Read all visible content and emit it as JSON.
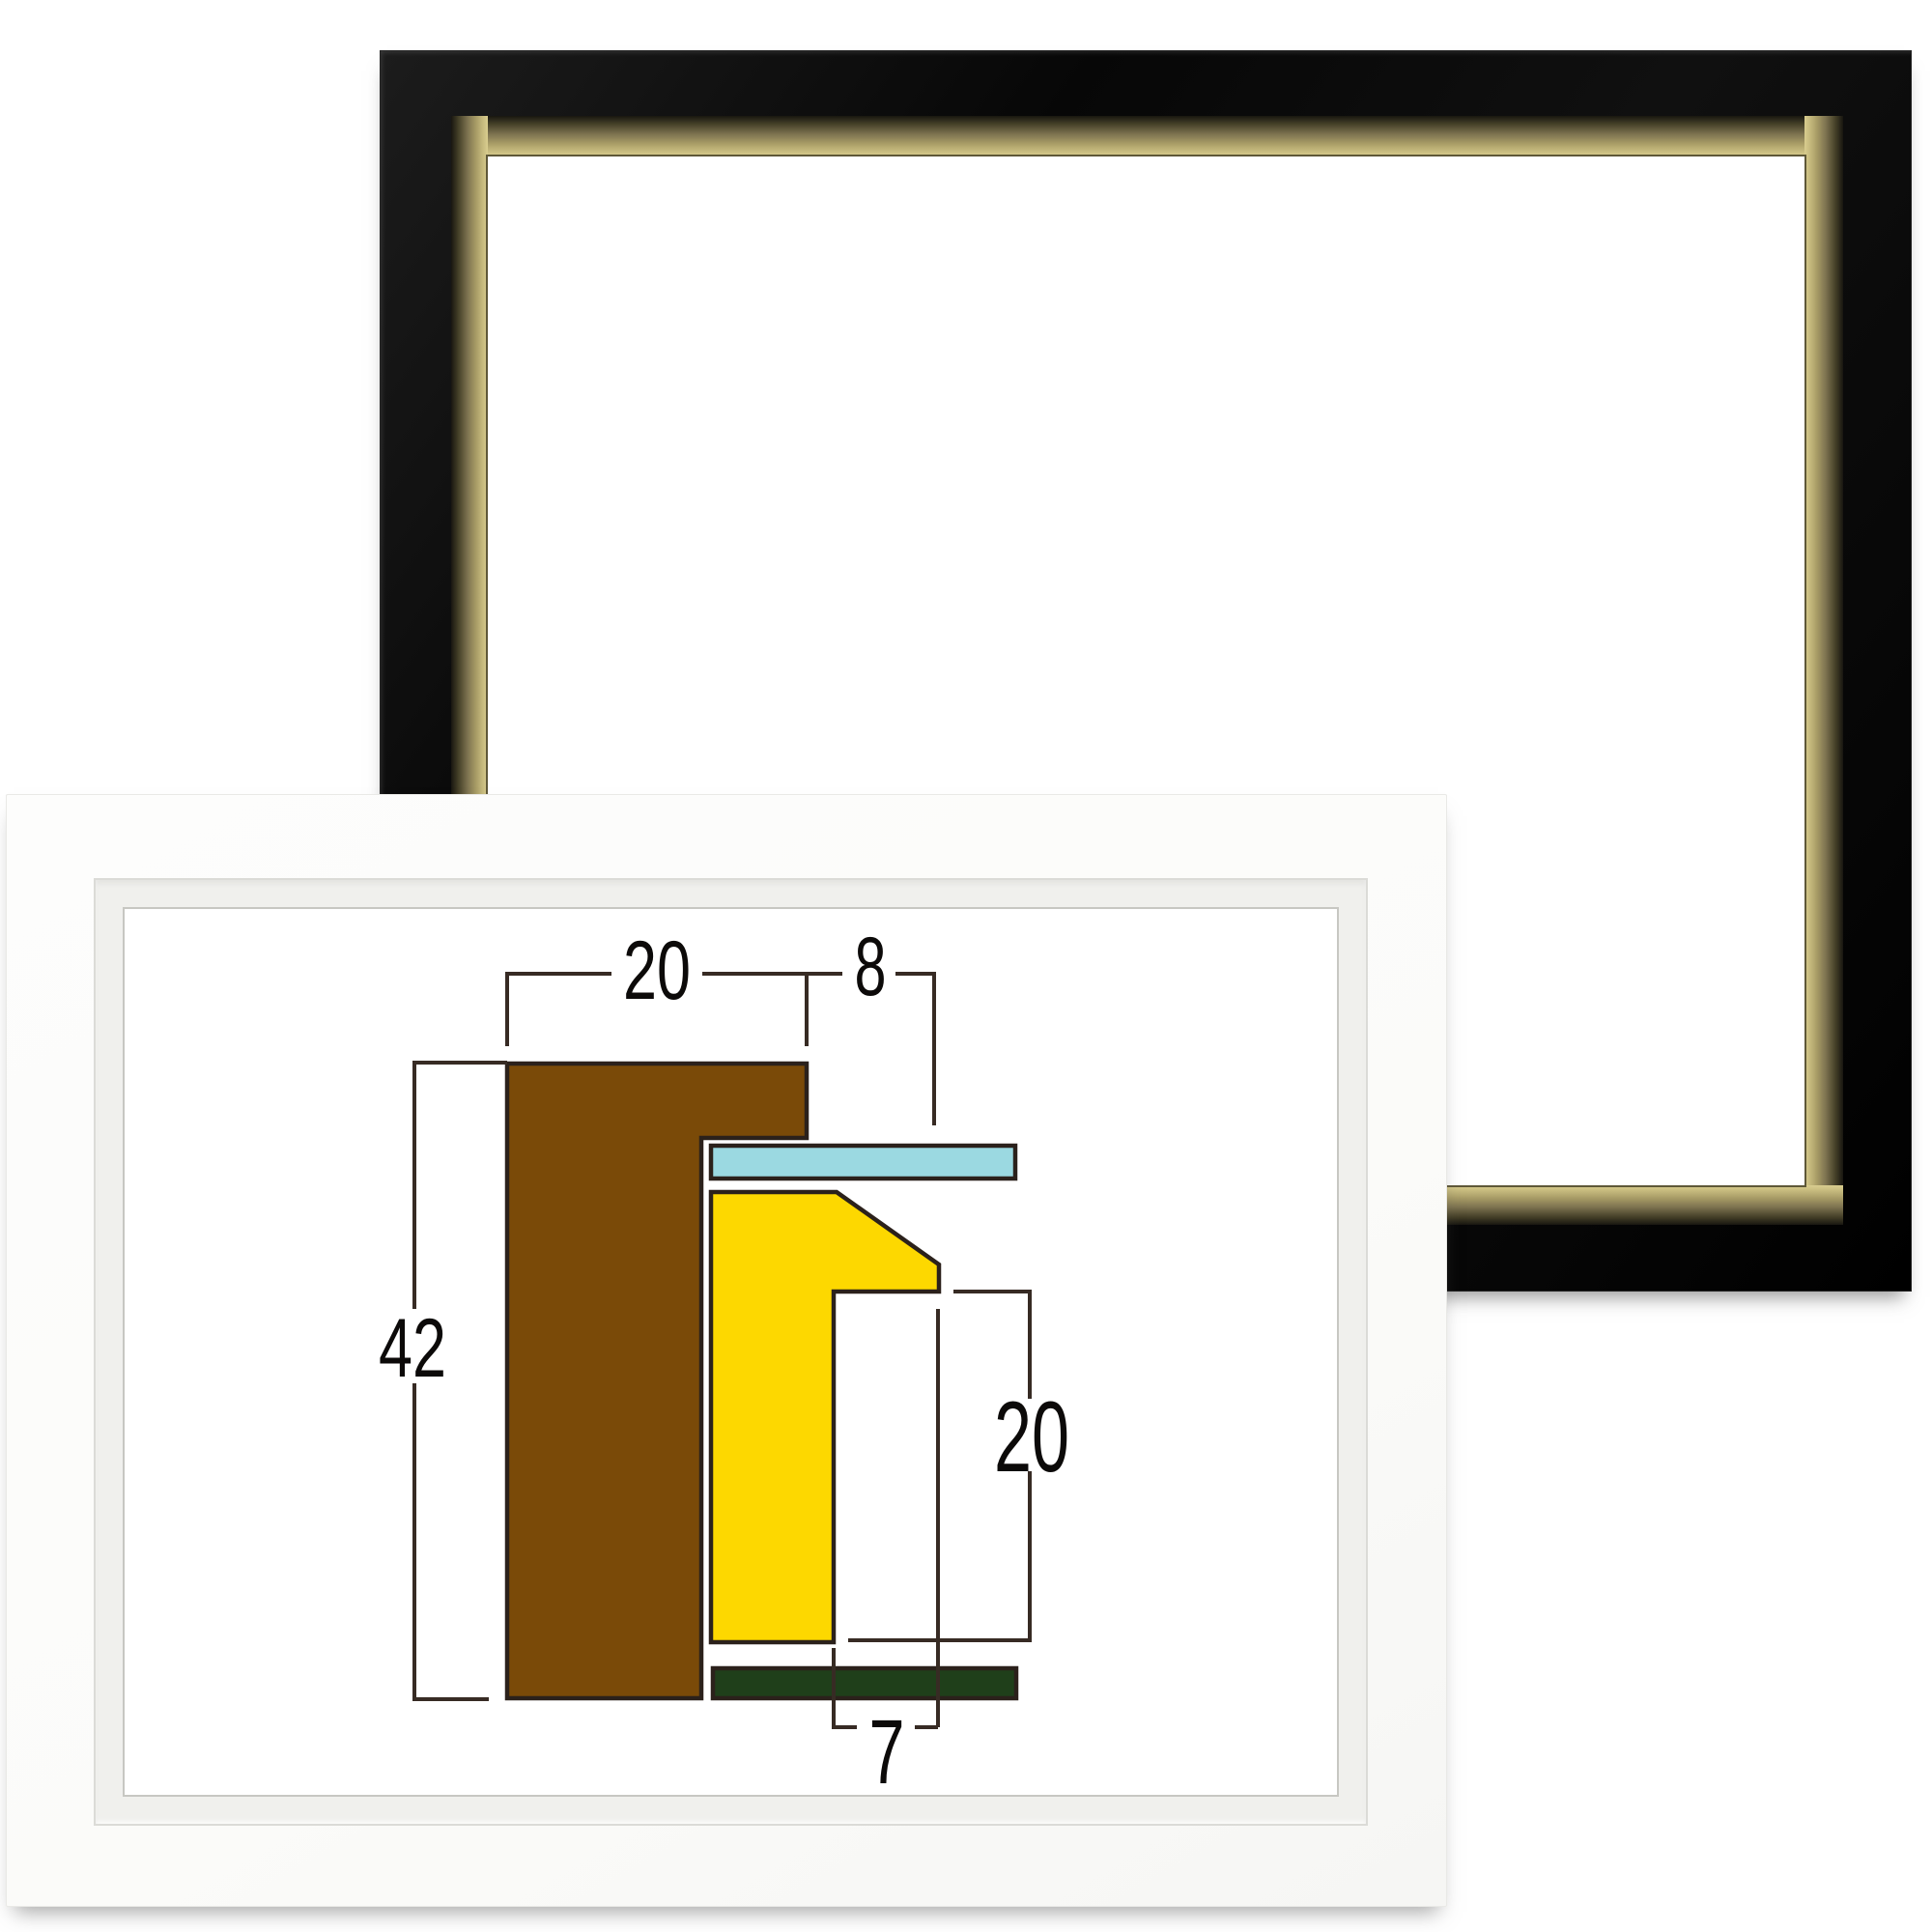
{
  "page": {
    "background_color": "#ffffff",
    "content": "two empty picture frames with moulding cross-section dimension diagram"
  },
  "black_frame": {
    "style": "glossy-black-with-gold-inner-lip",
    "face_color": "#0b0b0b",
    "lip_color": "#c9bd80",
    "opening_color": "#ffffff"
  },
  "white_frame": {
    "style": "matte-white",
    "face_color": "#fbfbfa",
    "lip_color": "#f0f0ed",
    "opening_color": "#ffffff"
  },
  "diagram": {
    "labels": {
      "top_width": "20",
      "lip_overhang": "8",
      "overall_height": "42",
      "rabbet_depth": "20",
      "rabbet_width": "7"
    },
    "dimensions_mm": {
      "top_width": 20,
      "lip_overhang": 8,
      "overall_height": 42,
      "rabbet_depth": 20,
      "rabbet_width": 7
    },
    "parts": {
      "moulding_color": "#7a4a08",
      "glass_color": "#9bd9e1",
      "liner_color": "#fdd800",
      "backing_color": "#1f3f1a",
      "outline_color": "#2b211b",
      "dimension_line_color": "#372b24",
      "label_color": "#0c0a09"
    }
  }
}
